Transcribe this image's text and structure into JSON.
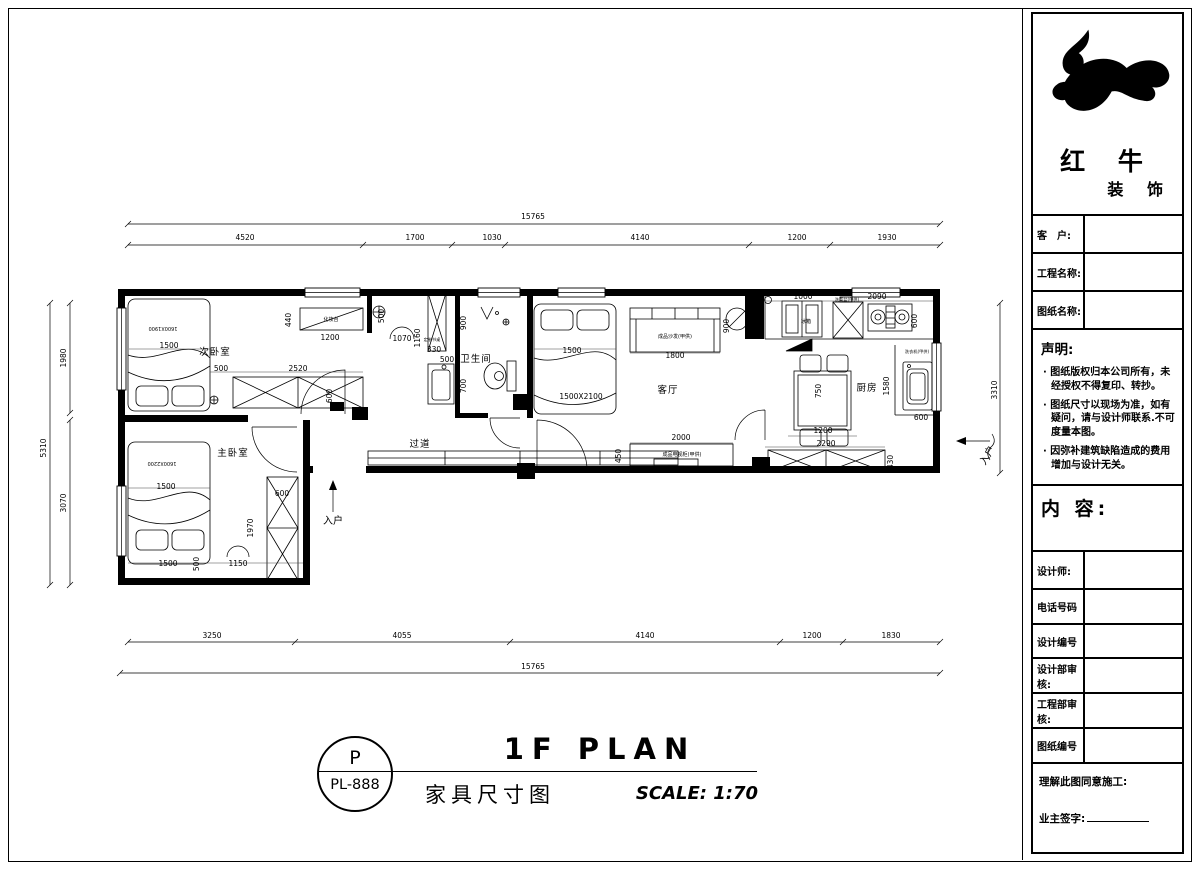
{
  "brand": {
    "name_top": "红 牛",
    "name_bottom": "装 饰"
  },
  "title_block": {
    "customer_label": "客　户:",
    "project_label": "工程名称:",
    "drawing_label": "图纸名称:",
    "statement_title": "声明:",
    "statement_items": [
      "图纸版权归本公司所有，未经授权不得复印、转抄。",
      "图纸尺寸以现场为准，如有疑问，请与设计师联系.不可度量本图。",
      "因弥补建筑缺陷造成的费用增加与设计无关。"
    ],
    "content_label": "内 容:",
    "designer_label": "设计师:",
    "phone_label": "电话号码",
    "design_no_label": "设计编号",
    "design_review_label": "设计部审核:",
    "eng_review_label": "工程部审核:",
    "drawing_no_label": "图纸编号",
    "approval_line": "理解此图同意施工:",
    "signature_label": "业主签字:"
  },
  "title_bar": {
    "stamp_letter": "P",
    "stamp_code": "PL-888",
    "title": "1F PLAN",
    "subtitle": "家具尺寸图",
    "scale": "SCALE: 1:70"
  },
  "plan": {
    "rooms": {
      "bedroom2": "次卧室",
      "bath": "卫生间",
      "living": "客厅",
      "kitchen": "厨房",
      "master": "主卧室",
      "corridor": "过道"
    },
    "furniture": {
      "dresser": "化妆台",
      "desk": "定制书桌",
      "sofa": "成品沙发(甲供)",
      "tv": "成品电视柜(甲供)",
      "fridge": "冰箱",
      "sink": "洗菜盆(甲供)",
      "washer": "洗衣机(甲供)"
    },
    "beds": {
      "bed2": "1600X1900",
      "living_bed": "1500X2100",
      "master_bed": "1600X2200"
    },
    "entry": "入户",
    "dims": {
      "top_total": "15765",
      "top": [
        "4520",
        "1700",
        "1030",
        "4140",
        "1200",
        "1930"
      ],
      "bottom": [
        "3250",
        "4055",
        "4140",
        "1200",
        "1830"
      ],
      "bottom_total": "15765",
      "left_total": "5310",
      "left": [
        "1980",
        "3070"
      ],
      "right_total": "3310",
      "interior": {
        "a440": "440",
        "a1200": "1200",
        "a500": "500",
        "a1070": "1070",
        "a1160": "1160",
        "a330": "330",
        "a500b": "500",
        "a500c": "500",
        "a2520": "2520",
        "a600": "600",
        "a1500": "1500",
        "b900": "900",
        "b700": "700",
        "c1500": "1500",
        "c1800": "1800",
        "c900": "900",
        "c2000": "2000",
        "c450": "450",
        "k1000": "1000",
        "k2090": "2090",
        "k600": "600",
        "k750": "750",
        "k1200": "1200",
        "k2290": "2290",
        "k1580": "1580",
        "k600b": "600",
        "k430": "430",
        "m1500": "1500",
        "m600": "600",
        "m1970": "1970",
        "m1150": "1150",
        "m500": "500",
        "m1500b": "1500"
      }
    }
  }
}
